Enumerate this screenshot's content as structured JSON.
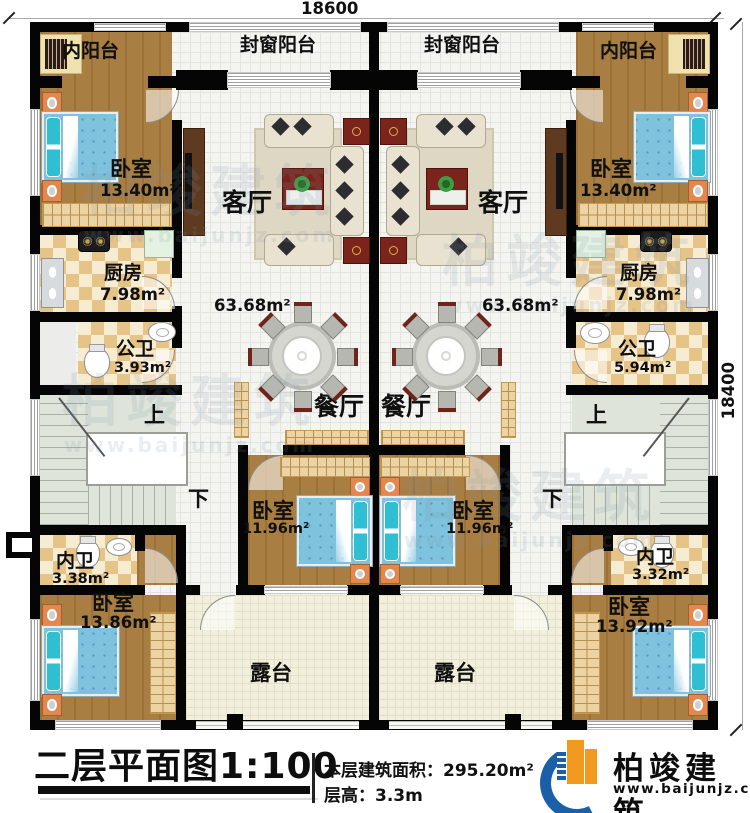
{
  "dimensions": {
    "top": "18600",
    "right": "18400"
  },
  "rooms": {
    "inner_balcony": "内阳台",
    "sealed_balcony": "封窗阳台",
    "bedroom": "卧室",
    "living_room": "客厅",
    "kitchen": "厨房",
    "public_bath": "公卫",
    "dining_room": "餐厅",
    "private_bath": "内卫",
    "terrace": "露台",
    "stairs_up": "上",
    "stairs_down": "下"
  },
  "areas": {
    "bedroom_top": "13.40m²",
    "kitchen": "7.98m²",
    "public_bath_left": "3.93m²",
    "public_bath_right": "5.94m²",
    "unit_area": "63.68m²",
    "bedroom_mid": "11.96m²",
    "private_bath_left": "3.38m²",
    "private_bath_right": "3.32m²",
    "bedroom_bottom_left": "13.86m²",
    "bedroom_bottom_right": "13.92m²"
  },
  "title_block": {
    "title": "二层平面图1:100",
    "floor_area_label": "本层建筑面积：295.20m²",
    "floor_height_label": "层高：3.3m",
    "brand": "柏竣建筑",
    "website": "www.baijunjz.com"
  },
  "watermark": {
    "brand": "柏竣建筑",
    "website": "www.baijunjz.com"
  }
}
